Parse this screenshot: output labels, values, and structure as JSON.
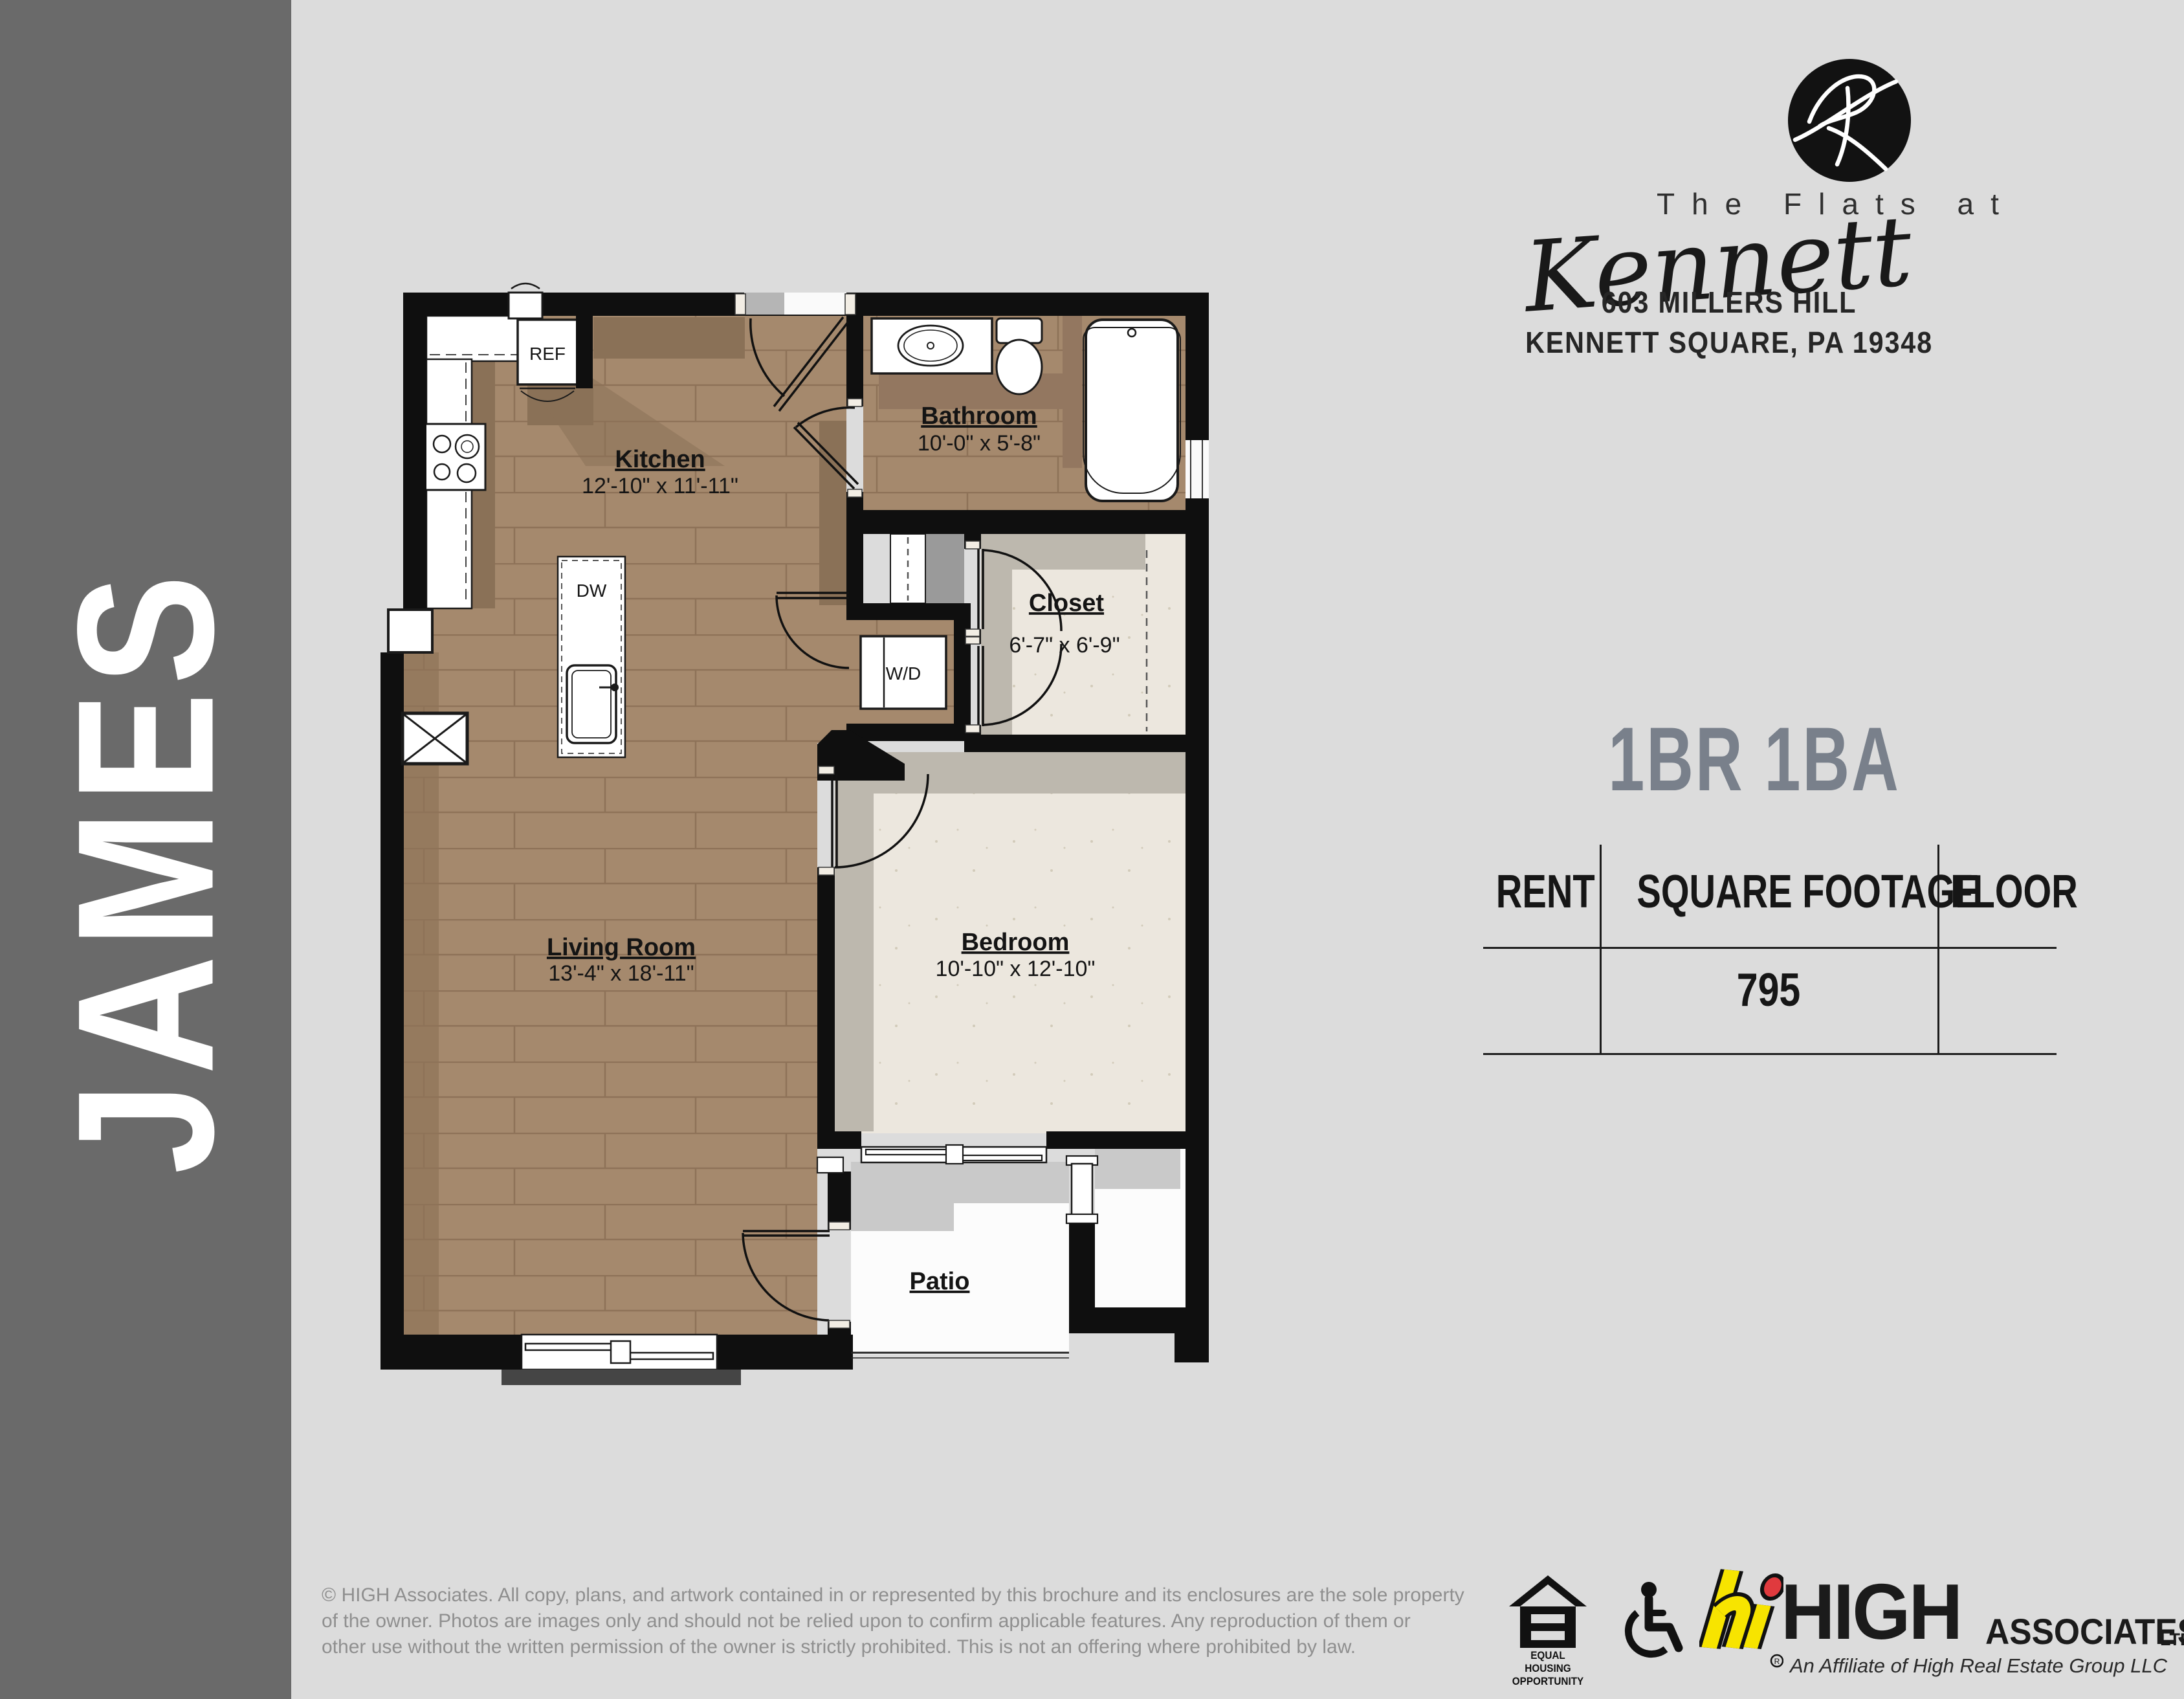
{
  "sidebar": {
    "label": "JAMES",
    "bg": "#6a6a6a"
  },
  "logo": {
    "monogram": "K-script-monogram",
    "name_top": "The Flats at",
    "name_script": "Kennett",
    "address_line1": "603 MILLERS HILL",
    "address_line2": "KENNETT SQUARE, PA 19348"
  },
  "unit": {
    "type_heading": "1BR 1BA",
    "accent_color": "#79808b"
  },
  "table": {
    "headers": [
      "RENT",
      "SQUARE FOOTAGE",
      "FLOOR"
    ],
    "row": {
      "rent": "",
      "square_footage": "795",
      "floor": ""
    }
  },
  "plan": {
    "rooms": [
      {
        "name": "Kitchen",
        "dims": "12'-10\" x 11'-11\""
      },
      {
        "name": "Bathroom",
        "dims": "10'-0\" x 5'-8\""
      },
      {
        "name": "Closet",
        "dims": "6'-7\" x 6'-9\""
      },
      {
        "name": "Bedroom",
        "dims": "10'-10\" x 12'-10\""
      },
      {
        "name": "Living Room",
        "dims": "13'-4\" x 18'-11\""
      },
      {
        "name": "Patio",
        "dims": ""
      }
    ],
    "fixtures": {
      "refrigerator": "REF",
      "dishwasher": "DW",
      "washer_dryer": "W/D"
    },
    "colors": {
      "wall": "#0f0f0f",
      "wood_floor": "#a5896d",
      "carpet_floor": "#ece7de"
    }
  },
  "footer": {
    "copyright_lines": [
      "© HIGH Associates. All copy, plans, and artwork contained in or represented by this brochure and its enclosures are the sole property",
      "of the owner. Photos are images only and should not be relied upon to confirm applicable features. Any reproduction of them or",
      "other use without the written permission of the owner is strictly prohibited. This is not an offering where prohibited by law."
    ],
    "eho_line1": "EQUAL HOUSING",
    "eho_line2": "OPPORTUNITY",
    "high": {
      "name": "HIGH",
      "associates": "ASSOCIATES",
      "ltd": "LTD.",
      "tagline": "An Affiliate of High Real Estate Group LLC",
      "yellow": "#f7e400",
      "red": "#e03a3e"
    }
  }
}
